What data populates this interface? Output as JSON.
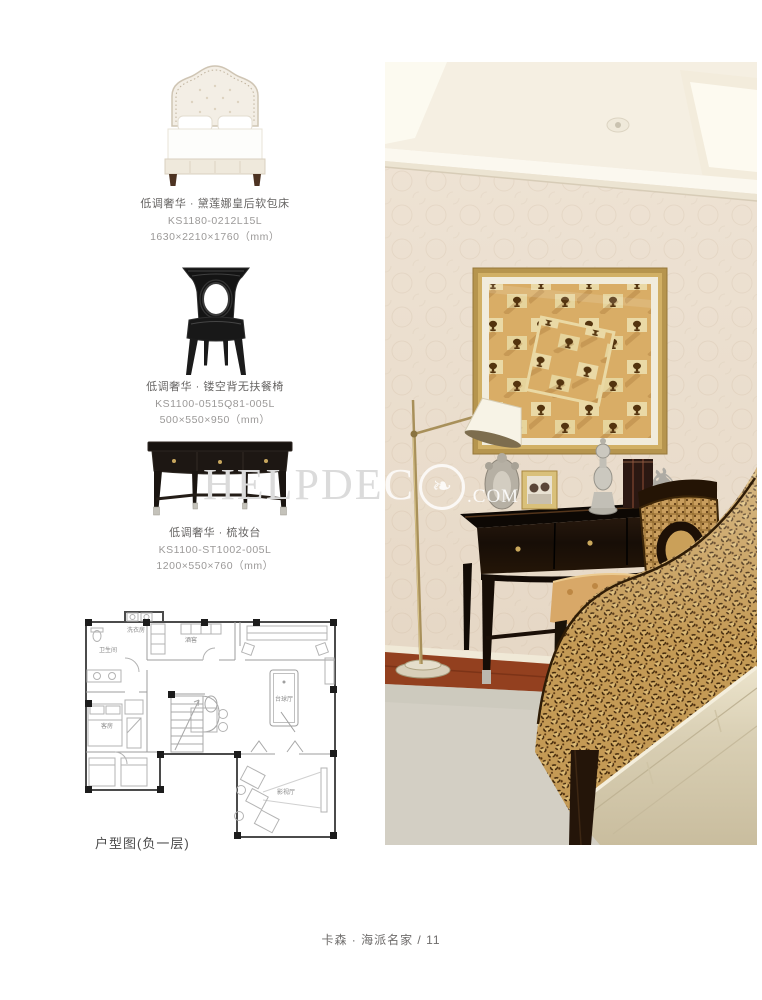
{
  "page": {
    "footer": "卡森 · 海派名家 / 11",
    "background": "#ffffff"
  },
  "watermark": {
    "brand": "HELPDECO.COM",
    "part1": "HELPDE",
    "part2": "C",
    "suffix": ".COM"
  },
  "products": [
    {
      "name": "低调奢华 · 黛莲娜皇后软包床",
      "model": "KS1180-0212L15L",
      "dims": "1630×2210×1760（mm）"
    },
    {
      "name": "低调奢华 · 镂空背无扶餐椅",
      "model": "KS1100-0515Q81-005L",
      "dims": "500×550×950（mm）"
    },
    {
      "name": "低调奢华 · 梳妆台",
      "model": "KS1100-ST1002-005L",
      "dims": "1200×550×760（mm）"
    }
  ],
  "floorplan": {
    "caption": "户型图(负一层)",
    "rooms": {
      "laundry": "洗衣房",
      "cellar": "酒窖",
      "bath": "卫生间",
      "guest": "客房",
      "billiards": "台球厅",
      "theater": "影视厅"
    }
  },
  "photo": {
    "colors": {
      "wallpaper": "#e9dccb",
      "frame_gold": "#b6954e",
      "desk": "#1c1209",
      "leopard_base": "#c49a55",
      "bench_leather": "#d9cfb6",
      "carpet": "#d3cfc4",
      "wood_floor": "#93401f"
    }
  }
}
